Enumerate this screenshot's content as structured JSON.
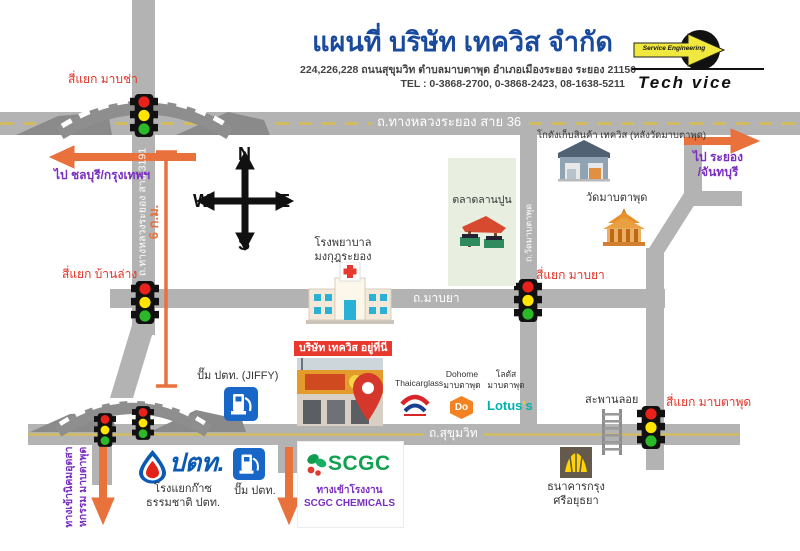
{
  "header": {
    "title": "แผนที่ บริษัท เทควิส จำกัด",
    "address": "224,226,228 ถนนสุขุมวิท ตำบลมาบตาพุด อำเภอเมืองระยอง ระยอง 21150",
    "tel": "TEL : 0-3868-2700, 0-3868-2423, 08-1638-5211",
    "logo": {
      "tagline": "Service Engineering",
      "brand": "Tech vice"
    }
  },
  "compass": {
    "north": "N",
    "east": "E",
    "south": "S",
    "west": "W"
  },
  "roads": {
    "highway36": "ถ.ทางหลวงระยอง สาย 36",
    "highway3191": "ถ.ทางหลวงระยอง สาย 3191",
    "mabya": "ถ.มาบยา",
    "sukhumvit": "ถ.สุขุมวิท",
    "wat_mabtaphut": "ถ.วัดมาบตาพุด"
  },
  "intersections": {
    "mabcha": "สี่แยก มาบช่า",
    "banlang": "สี่แยก บ้านล่าง",
    "mabya": "สี่แยก มาบยา",
    "mabtaphut": "สี่แยก มาบตาพุด"
  },
  "directions": {
    "to_chonburi": "ไป ชลบุรี/กรุงเทพฯ",
    "to_rayong_line1": "ไป ระยอง",
    "to_rayong_line2": "/จันทบุรี",
    "distance": "6 ก.ม.",
    "industrial_line1": "ทางเข้านิคมอุตสา",
    "industrial_line2": "หกรรม มาบตาพุด"
  },
  "places": {
    "market": "ตลาดลานปูน",
    "hospital_line1": "โรงพยาบาล",
    "hospital_line2": "มงกุฎระยอง",
    "warehouse": "โกดังเก็บสินค้า เทควิส (หลังวัดมาบตาพุด)",
    "temple": "วัดมาบตาพุด",
    "company_here": "บริษัท เทควิส อยู่ที่นี่",
    "jiffy": "ปั๊ม ปตท. (JIFFY)",
    "thaicarglass": "Thaicarglass",
    "dohome_line1": "Dohome",
    "dohome_line2": "มาบตาพุด",
    "dohome_logo": "Do",
    "lotus_line1": "โลตัส",
    "lotus_line2": "มาบตาพุด",
    "lotus_logo_1": "Lotus",
    "lotus_logo_2": "'",
    "lotus_logo_3": "s",
    "overpass": "สะพานลอย",
    "bank_line1": "ธนาคารกรุง",
    "bank_line2": "ศรีอยุธยา",
    "ptt_wordmark": "ปตท.",
    "gas_plant_line1": "โรงแยกก๊าซ",
    "gas_plant_line2": "ธรรมชาติ ปตท.",
    "ptt_station": "ปั๊ม ปตท.",
    "scgc_wordmark": "SCGC",
    "scgc_line1": "ทางเข้าโรงงาน",
    "scgc_line2": "SCGC CHEMICALS"
  },
  "colors": {
    "title_blue": "#1a4a9e",
    "road_gray": "#b3b3b3",
    "accent_orange": "#e8713c",
    "label_red": "#e03328",
    "label_purple": "#7a2fc0",
    "company_box_red": "#e8392f",
    "scgc_green": "#12a150",
    "lotus_teal": "#00b2a9",
    "dohome_orange": "#f58220",
    "ptt_blue": "#0a5ab4",
    "krungsri_yellow": "#ffd400"
  }
}
